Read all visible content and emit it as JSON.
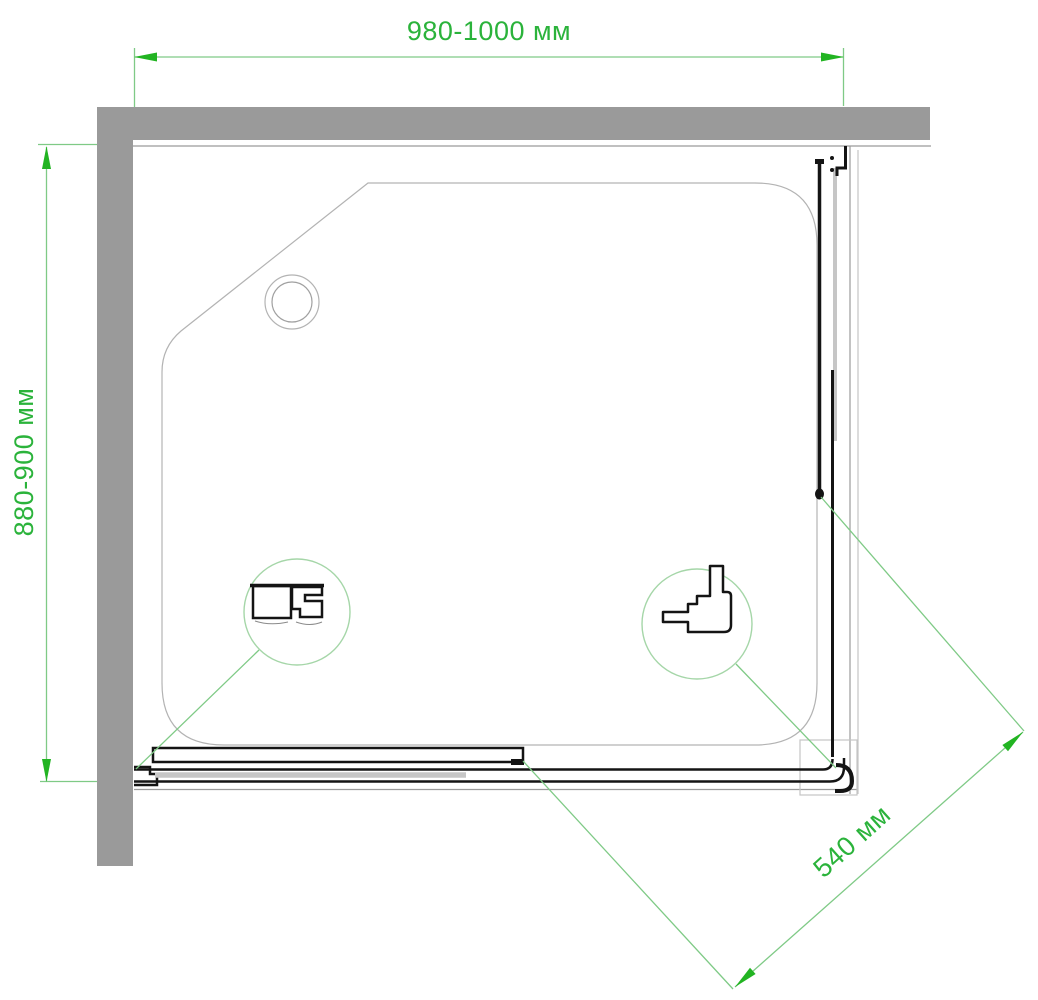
{
  "drawing": {
    "title": "shower-enclosure-top-view-drawing",
    "units": "мм"
  },
  "dimensions": {
    "width": {
      "label": "980-1000 мм"
    },
    "depth": {
      "label": "880-900 мм"
    },
    "door": {
      "label": "540 мм"
    }
  },
  "callouts": {
    "left": {
      "icon": "bottom-rail-profile-cross-section"
    },
    "right": {
      "icon": "corner-connector-profile-cross-section"
    }
  },
  "colors": {
    "text_green": "#2bb33b",
    "arrow_green": "#22b422",
    "line_green": "#7fca86",
    "circle_green": "#a5d6a8",
    "wall_gray": "#9a9a9a",
    "glass_gray": "#c6c6c6",
    "outline_gray": "#b3b3b3",
    "frame_gray": "#9b9b9b",
    "faint_gray": "#c4c4c4",
    "black": "#141414",
    "background": "#ffffff"
  }
}
